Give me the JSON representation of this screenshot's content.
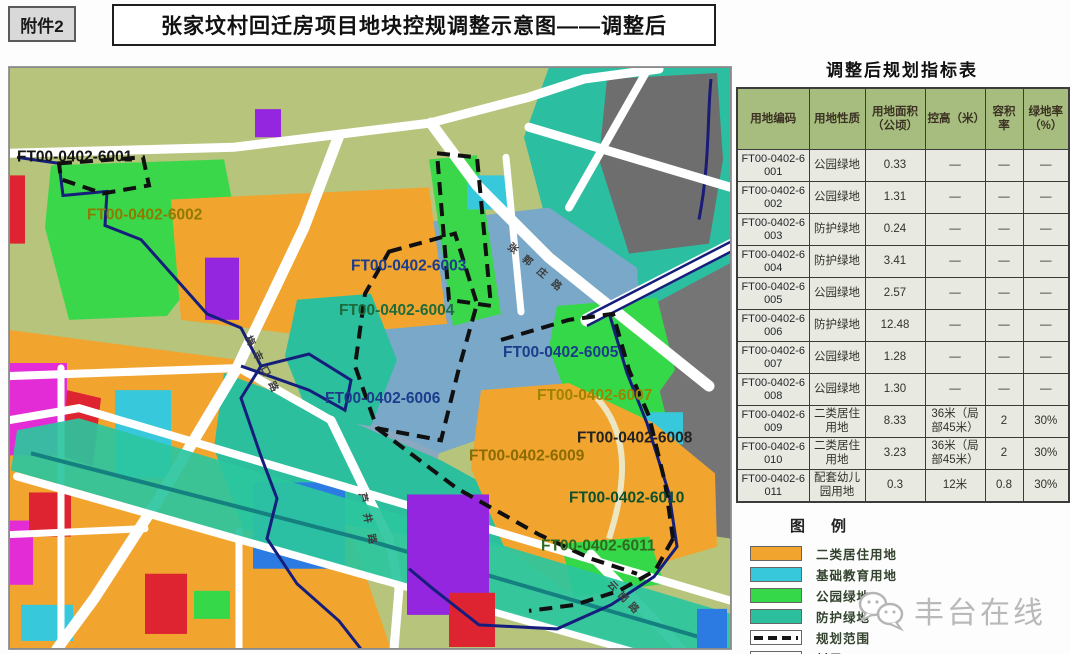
{
  "header": {
    "attachment": "附件2",
    "title": "张家坟村回迁房项目地块控规调整示意图——调整后"
  },
  "table": {
    "title": "调整后规划指标表",
    "headers": [
      "用地编码",
      "用地性质",
      "用地面积（公顷）",
      "控高（米）",
      "容积率",
      "绿地率（%）"
    ],
    "rows": [
      {
        "code": "FT00-0402-6001",
        "use": "公园绿地",
        "area": "0.33",
        "height": "—",
        "far": "—",
        "green": "—"
      },
      {
        "code": "FT00-0402-6002",
        "use": "公园绿地",
        "area": "1.31",
        "height": "—",
        "far": "—",
        "green": "—"
      },
      {
        "code": "FT00-0402-6003",
        "use": "防护绿地",
        "area": "0.24",
        "height": "—",
        "far": "—",
        "green": "—"
      },
      {
        "code": "FT00-0402-6004",
        "use": "防护绿地",
        "area": "3.41",
        "height": "—",
        "far": "—",
        "green": "—"
      },
      {
        "code": "FT00-0402-6005",
        "use": "公园绿地",
        "area": "2.57",
        "height": "—",
        "far": "—",
        "green": "—"
      },
      {
        "code": "FT00-0402-6006",
        "use": "防护绿地",
        "area": "12.48",
        "height": "—",
        "far": "—",
        "green": "—"
      },
      {
        "code": "FT00-0402-6007",
        "use": "公园绿地",
        "area": "1.28",
        "height": "—",
        "far": "—",
        "green": "—"
      },
      {
        "code": "FT00-0402-6008",
        "use": "公园绿地",
        "area": "1.30",
        "height": "—",
        "far": "—",
        "green": "—"
      },
      {
        "code": "FT00-0402-6009",
        "use": "二类居住用地",
        "area": "8.33",
        "height": "36米（局部45米）",
        "far": "2",
        "green": "30%"
      },
      {
        "code": "FT00-0402-6010",
        "use": "二类居住用地",
        "area": "3.23",
        "height": "36米（局部45米）",
        "far": "2",
        "green": "30%"
      },
      {
        "code": "FT00-0402-6011",
        "use": "配套幼儿园用地",
        "area": "0.3",
        "height": "12米",
        "far": "0.8",
        "green": "30%"
      }
    ]
  },
  "legend": {
    "title": "图例",
    "items": [
      {
        "label": "二类居住用地",
        "type": "fill",
        "color": "#F1A52F"
      },
      {
        "label": "基础教育用地",
        "type": "fill",
        "color": "#38C8DC"
      },
      {
        "label": "公园绿地",
        "type": "fill",
        "color": "#35D848"
      },
      {
        "label": "防护绿地",
        "type": "fill",
        "color": "#2BBF9D"
      },
      {
        "label": "规划范围",
        "type": "dashed",
        "color": "#161616"
      },
      {
        "label": "村界",
        "type": "line",
        "color": "#161E7C"
      }
    ]
  },
  "map": {
    "parcel_labels": [
      {
        "text": "FT00-0402-6001",
        "x": 8,
        "y": 94,
        "color": "#141414"
      },
      {
        "text": "FT00-0402-6002",
        "x": 78,
        "y": 152,
        "color": "#8f7a00"
      },
      {
        "text": "FT00-0402-6003",
        "x": 342,
        "y": 203,
        "color": "#1c3c8c"
      },
      {
        "text": "FT00-0402-6004",
        "x": 330,
        "y": 247,
        "color": "#1e6b3c"
      },
      {
        "text": "FT00-0402-6005",
        "x": 494,
        "y": 289,
        "color": "#1c3c8c"
      },
      {
        "text": "FT00-0402-6006",
        "x": 316,
        "y": 335,
        "color": "#1c3c8c"
      },
      {
        "text": "FT00-0402-6007",
        "x": 528,
        "y": 332,
        "color": "#9c8400"
      },
      {
        "text": "FT00-0402-6008",
        "x": 568,
        "y": 374,
        "color": "#222222"
      },
      {
        "text": "FT00-0402-6009",
        "x": 460,
        "y": 392,
        "color": "#8a6b00"
      },
      {
        "text": "FT00-0402-6010",
        "x": 560,
        "y": 434,
        "color": "#0e4f2c"
      },
      {
        "text": "FT00-0402-6011",
        "x": 532,
        "y": 482,
        "color": "#2f6b1e"
      }
    ],
    "road_labels": [
      {
        "text": "梅市口路",
        "x": 236,
        "y": 270,
        "angle": 63,
        "spacing": 7
      },
      {
        "text": "张郭庄路",
        "x": 498,
        "y": 180,
        "angle": 40,
        "spacing": 9
      },
      {
        "text": "芦井路",
        "x": 350,
        "y": 425,
        "angle": 78,
        "spacing": 11
      },
      {
        "text": "云岗路",
        "x": 598,
        "y": 516,
        "angle": 46,
        "spacing": 5
      }
    ]
  },
  "watermark": {
    "text": "丰台在线"
  }
}
